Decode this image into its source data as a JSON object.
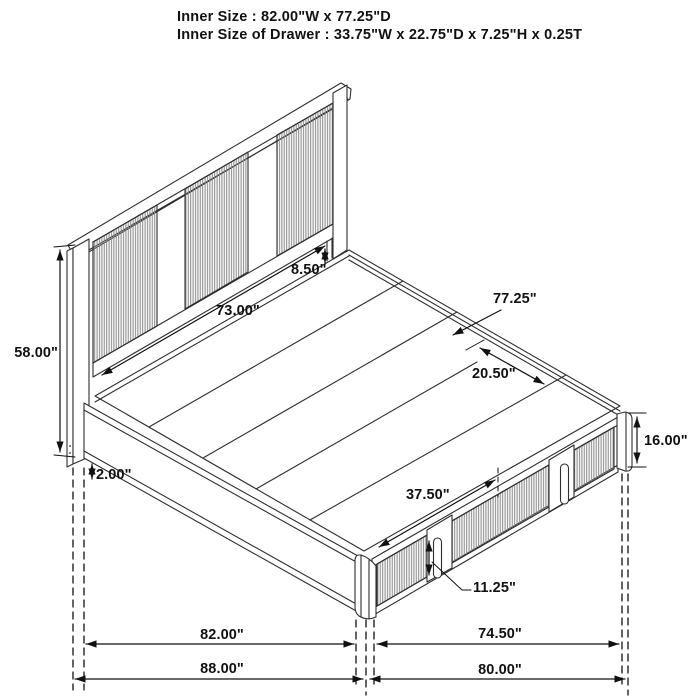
{
  "header": {
    "line1": "Inner Size : 82.00\"W x 77.25\"D",
    "line2": "Inner Size of Drawer : 33.75\"W x 22.75\"D x 7.25\"H x 0.25T"
  },
  "diagram": {
    "subject": "storage-bed-dimension-drawing",
    "labels": {
      "headboard_height": "58.00\"",
      "ground_clearance": "2.00\"",
      "headboard_panel_width": "73.00\"",
      "deck_to_panel_gap": "8.50\"",
      "bed_depth": "77.25\"",
      "rail_section_width": "20.50\"",
      "base_height": "16.00\"",
      "drawer_span": "37.50\"",
      "drawer_front_height": "11.25\"",
      "inner_width": "82.00\"",
      "foot_inner_width": "74.50\"",
      "outer_width": "88.00\"",
      "foot_outer_width": "80.00\""
    },
    "colors": {
      "line": "#2e2e2e",
      "dimension": "#111111",
      "fluting": "#8a8a8a",
      "background": "#ffffff"
    }
  }
}
